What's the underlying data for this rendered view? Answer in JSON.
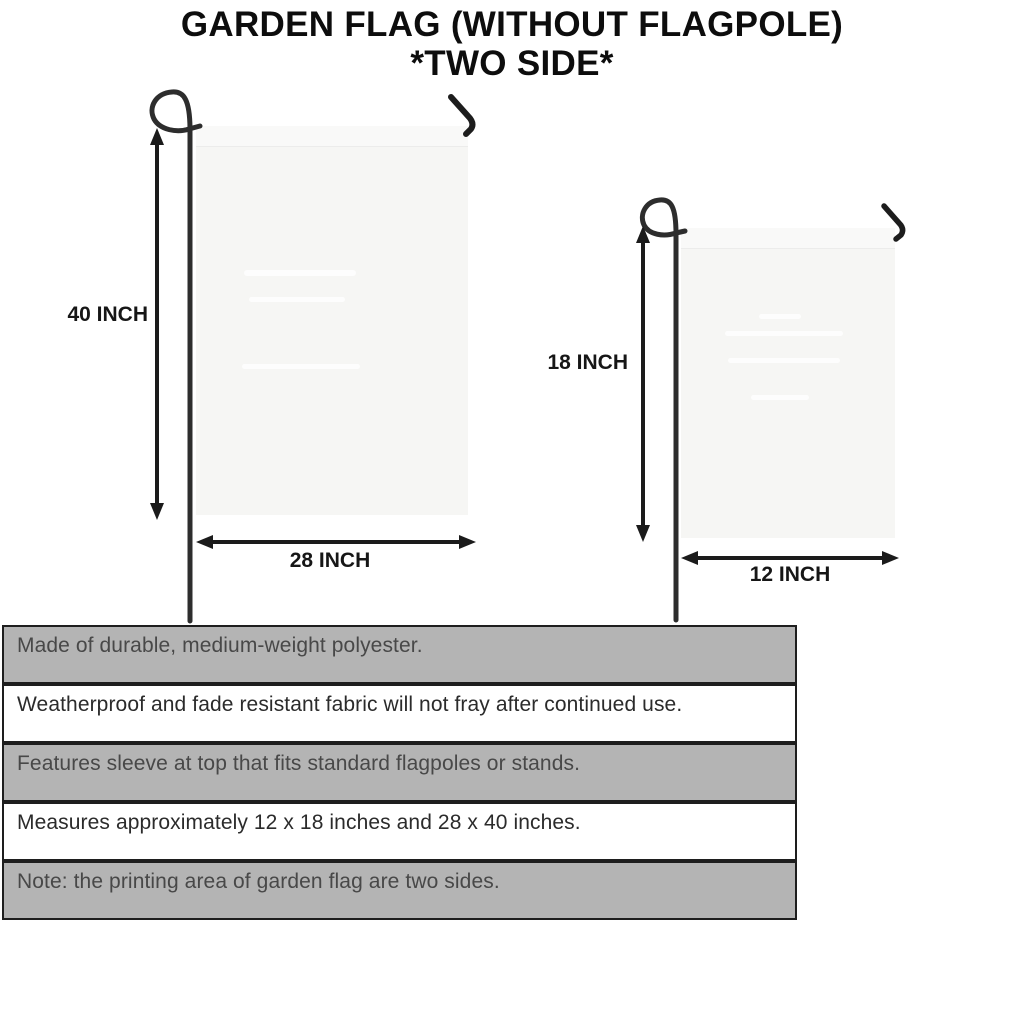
{
  "title": {
    "line1": "GARDEN FLAG (WITHOUT FLAGPOLE)",
    "line2": "*TWO SIDE*"
  },
  "flags": {
    "large": {
      "height_label": "40 INCH",
      "width_label": "28 INCH"
    },
    "small": {
      "height_label": "18 INCH",
      "width_label": "12 INCH"
    }
  },
  "features": [
    "Made of durable, medium-weight polyester.",
    "Weatherproof and fade resistant fabric will not fray after continued use.",
    "Features sleeve at top that fits standard flagpoles or stands.",
    "Measures approximately 12 x 18 inches and 28 x 40 inches.",
    "Note: the printing area of garden flag are two sides."
  ],
  "colors": {
    "row_gray": "#b4b4b4",
    "row_border": "#1e1e1e",
    "flag_fill": "#f6f6f4",
    "pole": "#2d2d2d",
    "arrow": "#1b1b1b",
    "title_text": "#0d0d0d"
  }
}
